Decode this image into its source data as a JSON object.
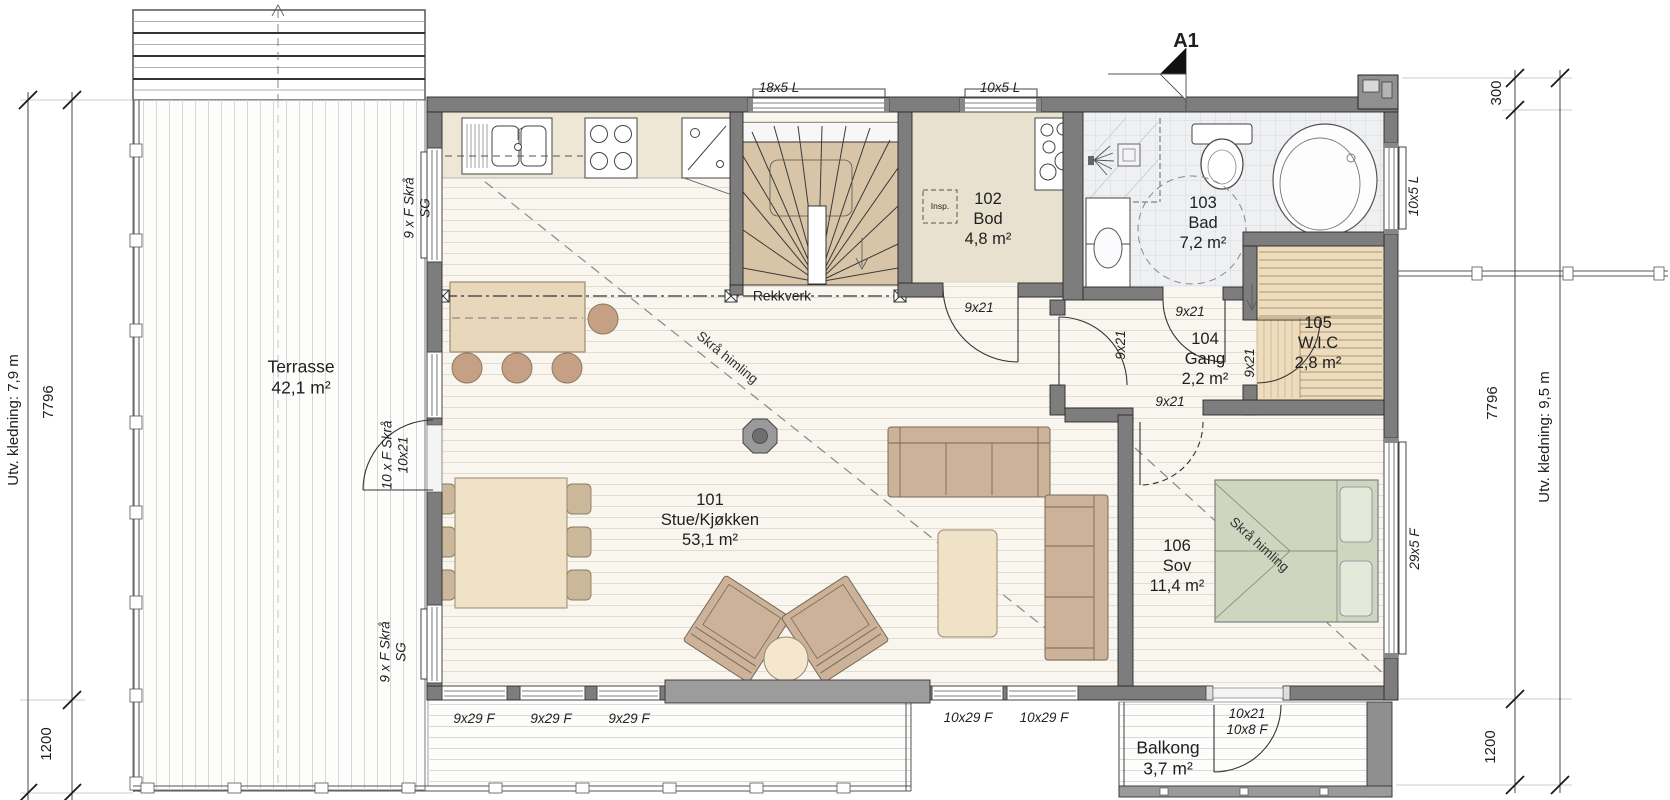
{
  "section_marker": {
    "label": "A1"
  },
  "rooms": {
    "stue": {
      "number": "101",
      "name": "Stue/Kjøkken",
      "area": "53,1 m²"
    },
    "bod": {
      "number": "102",
      "name": "Bod",
      "area": "4,8 m²"
    },
    "bad": {
      "number": "103",
      "name": "Bad",
      "area": "7,2 m²"
    },
    "gang": {
      "number": "104",
      "name": "Gang",
      "area": "2,2 m²"
    },
    "wic": {
      "number": "105",
      "name": "W.I.C",
      "area": "2,8 m²"
    },
    "sov": {
      "number": "106",
      "name": "Sov",
      "area": "11,4 m²"
    },
    "terrasse": {
      "name": "Terrasse",
      "area": "42,1 m²"
    },
    "balkong": {
      "name": "Balkong",
      "area": "3,7 m²"
    }
  },
  "annotations": {
    "rekkverk": "Rekkverk",
    "skra_himling_stue": "Skrå himling",
    "skra_himling_sov": "Skrå himling",
    "insp": "Insp."
  },
  "windows": {
    "north_stair": "18x5 L",
    "north_bod": "10x5 L",
    "east_bad": "10x5 L",
    "east_sov": "29x5 F",
    "south_stue_1": "9x29 F",
    "south_stue_2": "9x29 F",
    "south_stue_3": "9x29 F",
    "south_stue_4": "10x29 F",
    "south_stue_5": "10x29 F",
    "west_upper_line1": "9 x F Skrå",
    "west_upper_line2": "SG",
    "west_lower_line1": "9 x F Skrå",
    "west_lower_line2": "SG"
  },
  "doors": {
    "terrasse_line1": "10 x F Skrå",
    "terrasse_line2": "10x21",
    "bod": "9x21",
    "bad": "9x21",
    "stue_gang": "9x21",
    "wic": "9x21",
    "sov": "9x21",
    "balkong_line1": "10x21",
    "balkong_line2": "10x8 F"
  },
  "dimensions": {
    "left_outer": "Utv. kledning: 7,9 m",
    "left_height": "7796",
    "left_deck": "1200",
    "right_offset": "300",
    "right_height": "7796",
    "right_deck": "1200",
    "right_outer": "Utv. kledning: 9,5 m"
  },
  "colors": {
    "wall": "#7d7d7d",
    "floor": "#f9f6ef",
    "stair_tread": "#d8c5a7",
    "bod_floor": "#e9e1cf",
    "bath_floor": "#eef0f2",
    "wic_floor": "#eddcbd",
    "bed": "#cfd6c0",
    "sofa": "#cbb299",
    "accent_tan": "#f0e2c6"
  }
}
